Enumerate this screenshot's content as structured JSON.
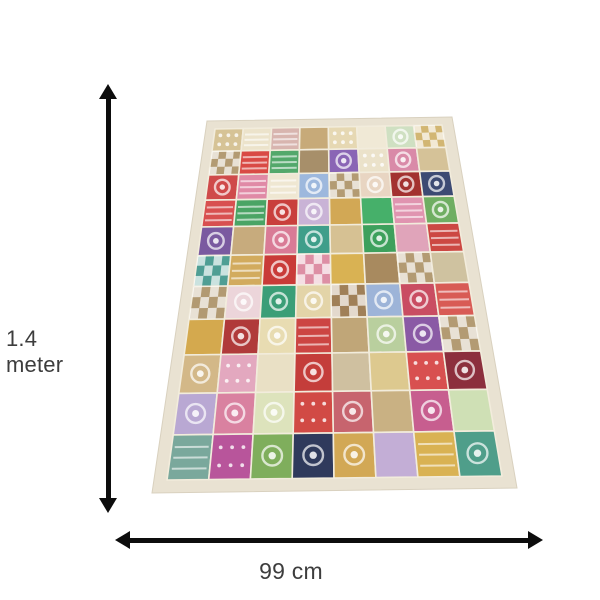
{
  "labels": {
    "height": "1.4 meter",
    "width": "99 cm"
  },
  "colors": {
    "background": "#ffffff",
    "arrow": "#0d0d0d",
    "label_text": "#3d3d3d",
    "rug_border": "#e9e2d2",
    "rug_border_edge": "#d9d1bf",
    "rug_stitch": "#f2ecdc"
  },
  "rug": {
    "description": "patchwork tapestry in perspective view",
    "grid": {
      "rows": 11,
      "cols": 8
    },
    "patches": [
      [
        "#d6c396:d",
        "#ece3cb:s",
        "#d8b5af:s",
        "#c7aa79:p",
        "#e6d8b3:d",
        "#f0e9d6:p",
        "#cfe0c2:f",
        "#d2b673:x"
      ],
      [
        "#b39b73:x",
        "#d94a45:s",
        "#53a86b:s",
        "#a78f6a:p",
        "#8a65b5:f",
        "#ebe2ca:d",
        "#d98aa8:f",
        "#d5c298:p"
      ],
      [
        "#cf4a4a:f",
        "#e08aa6:s",
        "#efe7d2:s",
        "#9db8dd:f",
        "#b39b73:x",
        "#e8d5c2:f",
        "#a33230:f",
        "#3c4a73:f"
      ],
      [
        "#d85050:s",
        "#4aa465:s",
        "#c93f3c:f",
        "#c9b3d6:f",
        "#d2a855:p",
        "#46b06a:p",
        "#e094b0:s",
        "#6fae62:f"
      ],
      [
        "#7a5aa0:f",
        "#c7ab7d:p",
        "#d97b96:f",
        "#3f9e8a:f",
        "#d6c193:p",
        "#3da05c:f",
        "#e0a4ba:p",
        "#cc4843:s"
      ],
      [
        "#4f9e94:x",
        "#d2ab5e:s",
        "#c93b38:f",
        "#dd8fa5:x",
        "#d9b253:p",
        "#a88a5f:p",
        "#b39b73:x",
        "#cfc2a0:p"
      ],
      [
        "#b29a72:x",
        "#ecd5da:f",
        "#3b9e77:f",
        "#e3d4a8:f",
        "#a08058:x",
        "#9db4d8:f",
        "#c94d62:f",
        "#d85b55:s"
      ],
      [
        "#d4a94e:p",
        "#b03a3a:f",
        "#e8dcb2:f",
        "#cc4543:s",
        "#c0a678:p",
        "#b9cf9e:f",
        "#8a5aa5:f",
        "#b39b73:x"
      ],
      [
        "#d3b888:f",
        "#e3a8bf:d",
        "#e9e0c5:p",
        "#c43d3a:f",
        "#cfc0a0:p",
        "#ddc98f:p",
        "#d85050:d",
        "#8c2f3d:f"
      ],
      [
        "#b9a8d3:f",
        "#d981a0:f",
        "#dde3bc:f",
        "#d14a45:d",
        "#c7646e:f",
        "#c9b183:p",
        "#c75e8f:f",
        "#cfe0b5:p"
      ],
      [
        "#7aa89c:s",
        "#b8559b:d",
        "#7fae5c:f",
        "#2f3a5c:f",
        "#d2a855:f",
        "#c3aed6:p",
        "#d9b253:s",
        "#4f9e8a:f"
      ]
    ]
  }
}
